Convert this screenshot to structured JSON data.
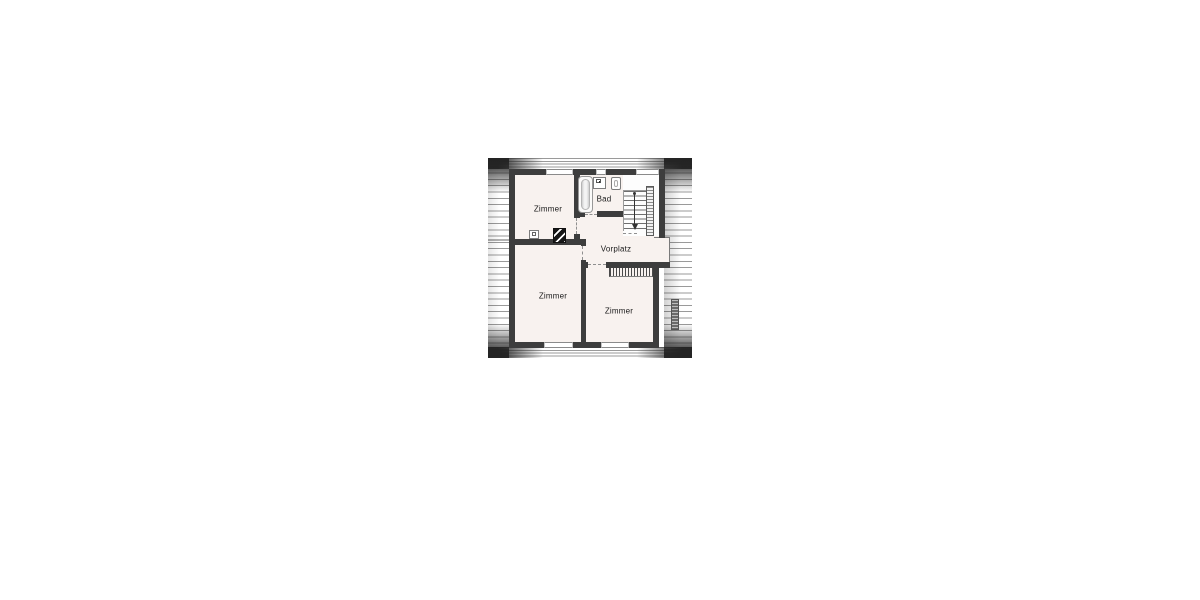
{
  "plan_type": "attic floor plan",
  "rooms": [
    {
      "name": "zimmer-top-left",
      "label": "Zimmer"
    },
    {
      "name": "bad",
      "label": "Bad"
    },
    {
      "name": "vorplatz",
      "label": "Vorplatz"
    },
    {
      "name": "zimmer-bottom-left",
      "label": "Zimmer"
    },
    {
      "name": "zimmer-bottom-right",
      "label": "Zimmer"
    }
  ],
  "fixtures": [
    {
      "name": "bathtub-icon",
      "room": "Bad"
    },
    {
      "name": "washbasin-icon",
      "room": "Bad"
    },
    {
      "name": "toilet-icon",
      "room": "Bad"
    },
    {
      "name": "staircase",
      "direction": "down"
    },
    {
      "name": "stair-railing"
    },
    {
      "name": "chimney-icon"
    },
    {
      "name": "small-washbasin-icon"
    }
  ],
  "colors": {
    "background": "#ffffff",
    "wall": "#3d3d3d",
    "room_fill": "#f8f2ef",
    "hatch_line": "#9a9a9a",
    "fixture_outline": "#8a8a8a",
    "text": "#1a1a1a"
  }
}
